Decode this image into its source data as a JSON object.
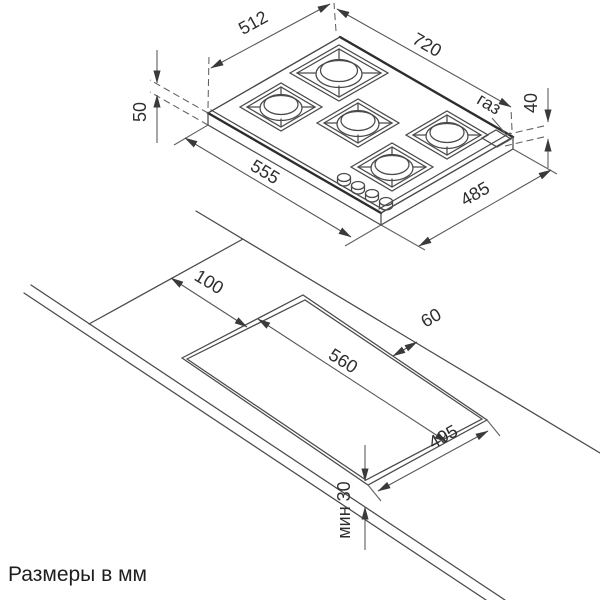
{
  "hob": {
    "dim_width_top": "512",
    "dim_width_total": "720",
    "dim_height_left": "50",
    "dim_height_right": "40",
    "dim_depth_left": "555",
    "dim_depth_right": "485",
    "gas_label": "газ"
  },
  "cutout": {
    "dim_offset_left": "100",
    "dim_offset_back": "60",
    "dim_width": "560",
    "dim_depth": "495",
    "dim_min_front": "мин 30"
  },
  "note": {
    "units": "Размеры в мм"
  }
}
